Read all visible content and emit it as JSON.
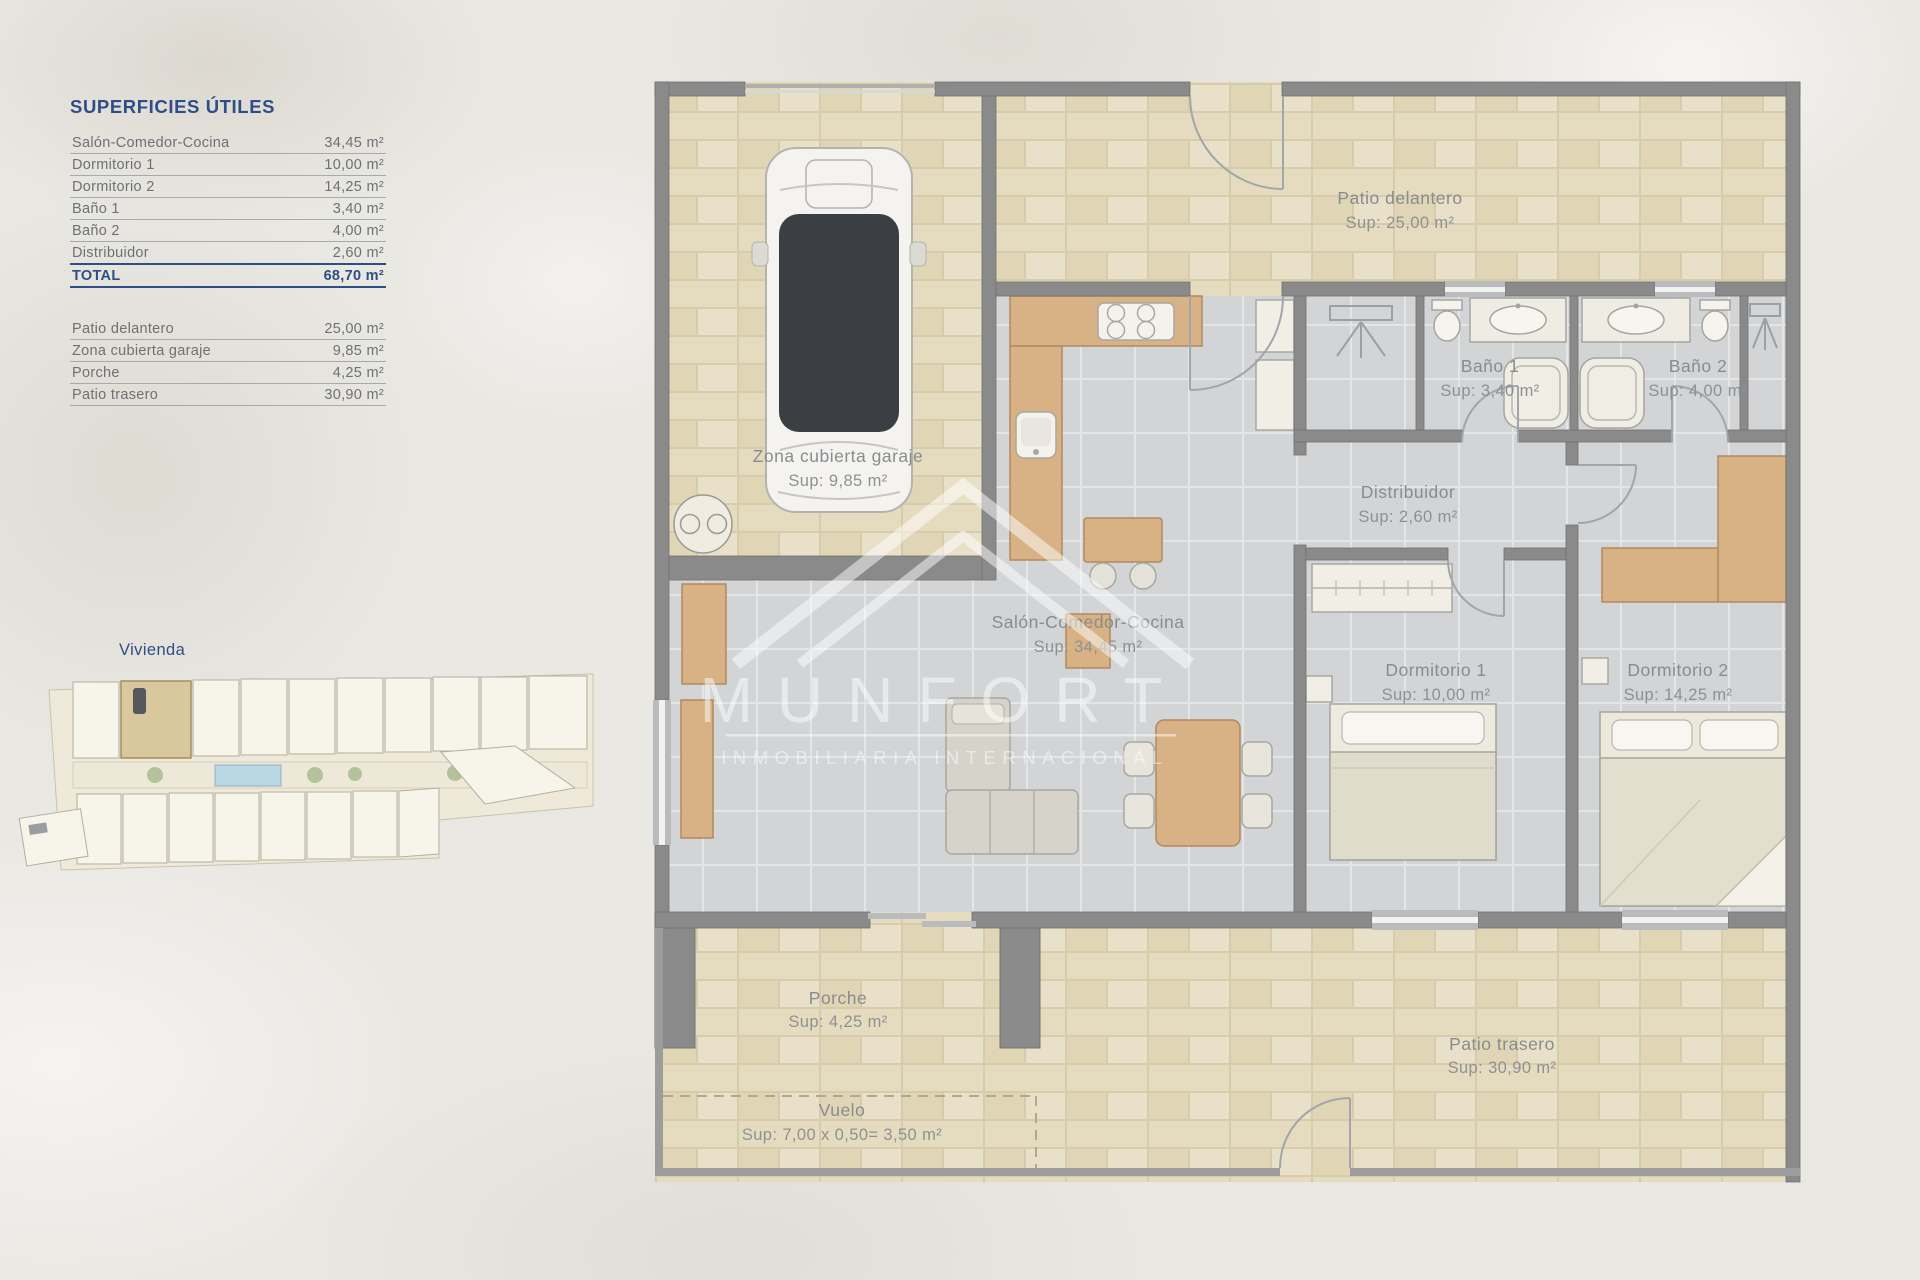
{
  "surfaces_panel": {
    "title": "SUPERFICIES ÚTILES",
    "useful": [
      {
        "label": "Salón-Comedor-Cocina",
        "value": "34,45 m²"
      },
      {
        "label": "Dormitorio 1",
        "value": "10,00 m²"
      },
      {
        "label": "Dormitorio 2",
        "value": "14,25 m²"
      },
      {
        "label": "Baño 1",
        "value": "3,40 m²"
      },
      {
        "label": "Baño 2",
        "value": "4,00 m²"
      },
      {
        "label": "Distribuidor",
        "value": "2,60 m²"
      }
    ],
    "total": {
      "label": "TOTAL",
      "value": "68,70 m²"
    },
    "exterior": [
      {
        "label": "Patio delantero",
        "value": "25,00 m²"
      },
      {
        "label": "Zona cubierta garaje",
        "value": "9,85 m²"
      },
      {
        "label": "Porche",
        "value": "4,25 m²"
      },
      {
        "label": "Patio trasero",
        "value": "30,90 m²"
      }
    ]
  },
  "site_plan": {
    "title": "Vivienda"
  },
  "watermark": {
    "brand": "MUNFORT",
    "subtitle": "INMOBILIARIA INTERNACIONAL"
  },
  "rooms": {
    "patio_delantero": {
      "name": "Patio delantero",
      "sup": "Sup: 25,00 m²"
    },
    "garaje": {
      "name": "Zona cubierta garaje",
      "sup": "Sup: 9,85 m²"
    },
    "bano1": {
      "name": "Baño 1",
      "sup": "Sup: 3,40 m²"
    },
    "bano2": {
      "name": "Baño 2",
      "sup": "Sup: 4,00 m²"
    },
    "distribuidor": {
      "name": "Distribuidor",
      "sup": "Sup: 2,60 m²"
    },
    "salon": {
      "name": "Salón-Comedor-Cocina",
      "sup": "Sup: 34,45 m²"
    },
    "dorm1": {
      "name": "Dormitorio 1",
      "sup": "Sup: 10,00 m²"
    },
    "dorm2": {
      "name": "Dormitorio 2",
      "sup": "Sup: 14,25 m²"
    },
    "porche": {
      "name": "Porche",
      "sup": "Sup: 4,25 m²"
    },
    "patio_trasero": {
      "name": "Patio trasero",
      "sup": "Sup: 30,90 m²"
    },
    "vuelo": {
      "name": "Vuelo",
      "sup": "Sup: 7,00 x 0,50= 3,50 m²"
    }
  },
  "colors": {
    "accent_navy": "#2e4e86",
    "wall_gray": "#8a8a8a",
    "floor_gray": "#d2d4d6",
    "tile_beige": "#e2d9bc",
    "wood": "#d8b184",
    "label_gray": "#898c8f",
    "watermark_white": "#ffffff"
  }
}
